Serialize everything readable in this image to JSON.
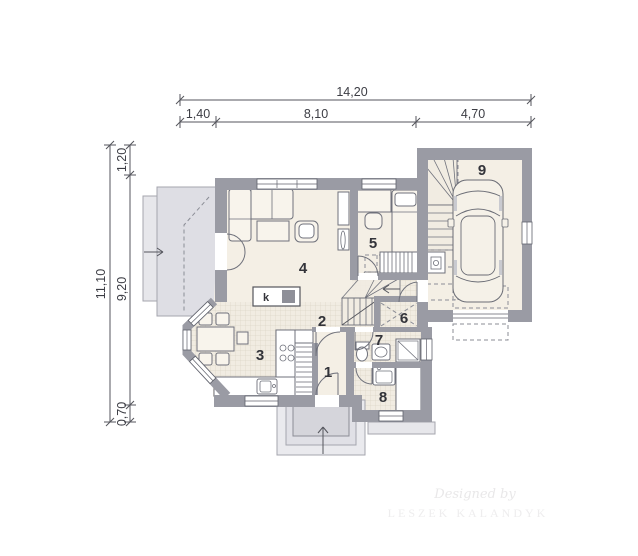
{
  "drawing_title": "house ground floor plan",
  "dimensions": {
    "top_total": "14,20",
    "top_segments": [
      "1,40",
      "8,10",
      "4,70"
    ],
    "left_total": "11,10",
    "left_segments": [
      "1,20",
      "9,20",
      "0,70"
    ]
  },
  "rooms": [
    {
      "number": "1"
    },
    {
      "number": "2"
    },
    {
      "number": "3"
    },
    {
      "number": "4"
    },
    {
      "number": "5"
    },
    {
      "number": "6"
    },
    {
      "number": "7"
    },
    {
      "number": "8"
    },
    {
      "number": "9"
    }
  ],
  "fireplace_label": "k",
  "watermark": {
    "line1": "Designed by",
    "line2": "LESZEK KALANDYK"
  },
  "colors": {
    "wall": "#9a9ba4",
    "floor": "#f4efe5",
    "tile": "#f1ece2",
    "tile_grid": "#dcd6c8",
    "terrace": "#dedee4",
    "dimension_line": "#54555c"
  }
}
